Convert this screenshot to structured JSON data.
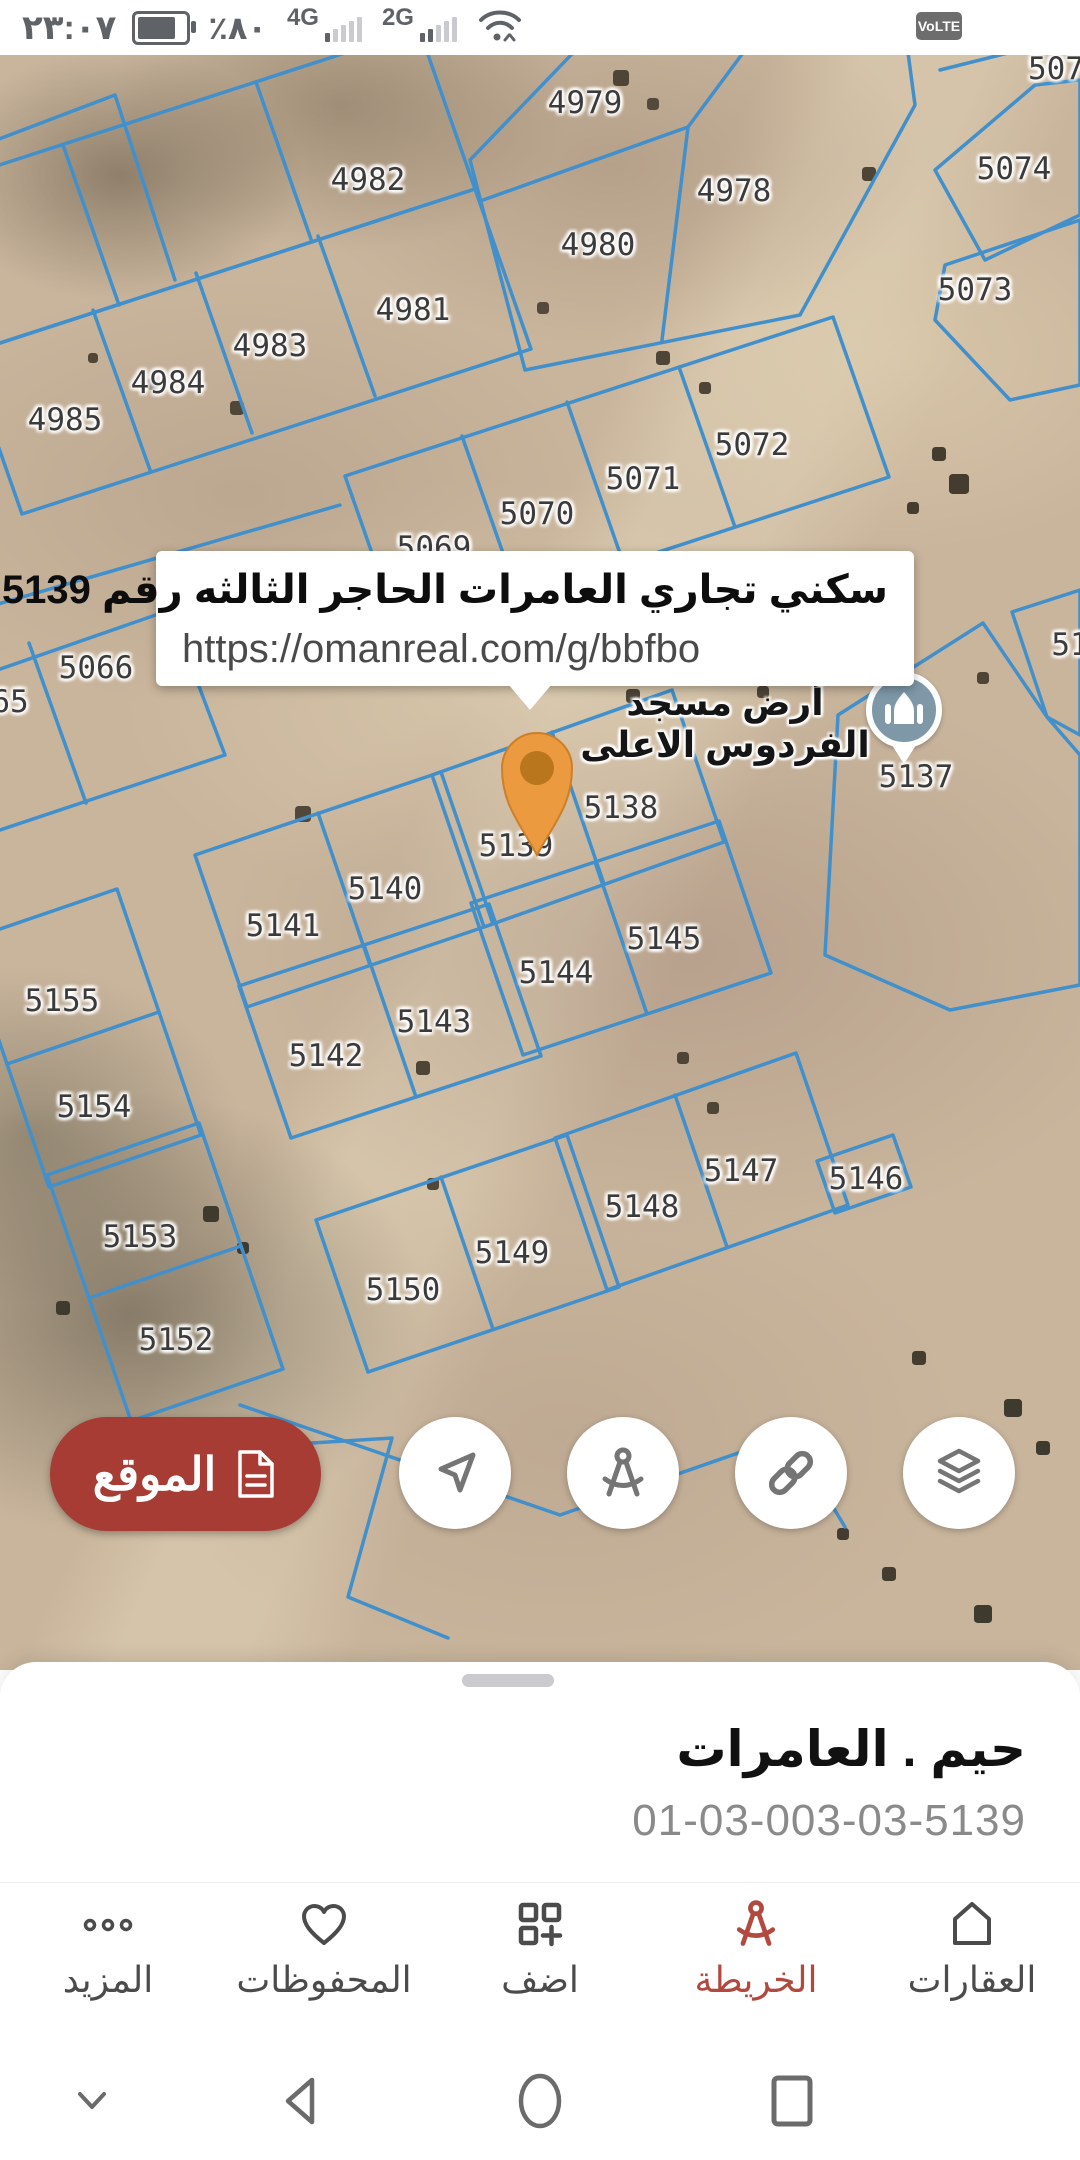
{
  "status_bar": {
    "time": "٢٣:٠٧",
    "battery_percent": "٪٨٠",
    "network_a": "4G",
    "network_b": "2G",
    "volte_badge": "VoLTE"
  },
  "map": {
    "popup": {
      "title": "سكني تجاري العامرات الحاجر الثالثه رقم 5139",
      "url": "https://omanreal.com/g/bbfbo"
    },
    "mosque_label": {
      "line1": "أرض مسجد",
      "line2": "الفردوس الاعلى"
    },
    "location_button": {
      "label": "الموقع"
    },
    "marker_parcel": "5139",
    "parcels": [
      {
        "n": "4979",
        "x": 585,
        "y": 48
      },
      {
        "n": "507",
        "x": 1056,
        "y": 14
      },
      {
        "n": "4982",
        "x": 368,
        "y": 125
      },
      {
        "n": "4978",
        "x": 734,
        "y": 136
      },
      {
        "n": "5074",
        "x": 1014,
        "y": 114
      },
      {
        "n": "4980",
        "x": 598,
        "y": 190
      },
      {
        "n": "5073",
        "x": 975,
        "y": 235
      },
      {
        "n": "4981",
        "x": 413,
        "y": 255
      },
      {
        "n": "4983",
        "x": 270,
        "y": 291
      },
      {
        "n": "4984",
        "x": 168,
        "y": 328
      },
      {
        "n": "4985",
        "x": 65,
        "y": 365
      },
      {
        "n": "5072",
        "x": 752,
        "y": 390
      },
      {
        "n": "5071",
        "x": 643,
        "y": 424
      },
      {
        "n": "5070",
        "x": 537,
        "y": 459
      },
      {
        "n": "5069",
        "x": 434,
        "y": 493
      },
      {
        "n": "5066",
        "x": 96,
        "y": 613
      },
      {
        "n": "65",
        "x": 10,
        "y": 647
      },
      {
        "n": "51",
        "x": 1070,
        "y": 590
      },
      {
        "n": "5137",
        "x": 916,
        "y": 722
      },
      {
        "n": "5138",
        "x": 621,
        "y": 753
      },
      {
        "n": "5139",
        "x": 516,
        "y": 791
      },
      {
        "n": "5140",
        "x": 385,
        "y": 834
      },
      {
        "n": "5141",
        "x": 283,
        "y": 871
      },
      {
        "n": "5145",
        "x": 664,
        "y": 884
      },
      {
        "n": "5144",
        "x": 556,
        "y": 918
      },
      {
        "n": "5143",
        "x": 434,
        "y": 967
      },
      {
        "n": "5155",
        "x": 62,
        "y": 946
      },
      {
        "n": "5142",
        "x": 326,
        "y": 1001
      },
      {
        "n": "5154",
        "x": 94,
        "y": 1052
      },
      {
        "n": "5153",
        "x": 140,
        "y": 1182
      },
      {
        "n": "5147",
        "x": 741,
        "y": 1116
      },
      {
        "n": "5146",
        "x": 866,
        "y": 1124
      },
      {
        "n": "5148",
        "x": 642,
        "y": 1152
      },
      {
        "n": "5149",
        "x": 512,
        "y": 1198
      },
      {
        "n": "5150",
        "x": 403,
        "y": 1235
      },
      {
        "n": "5152",
        "x": 176,
        "y": 1285
      }
    ]
  },
  "bottom_sheet": {
    "title": "حيم . العامرات",
    "parcel_code": "01-03-003-03-5139"
  },
  "bottom_nav": {
    "items": [
      {
        "label": "العقارات",
        "icon": "home-icon",
        "active": false
      },
      {
        "label": "الخريطة",
        "icon": "compass-icon",
        "active": true
      },
      {
        "label": "اضف",
        "icon": "add-grid-icon",
        "active": false
      },
      {
        "label": "المحفوظات",
        "icon": "heart-icon",
        "active": false
      },
      {
        "label": "المزيد",
        "icon": "more-dots-icon",
        "active": false
      }
    ]
  },
  "android_nav": {
    "buttons": [
      "collapse-chevron",
      "back",
      "home",
      "recents"
    ]
  },
  "colors": {
    "accent_red": "#a63c33",
    "active_nav_red": "#b2493f",
    "parcel_blue": "#4190cc",
    "pin_orange": "#ec9a3f",
    "mosque_pin_blue": "#7e98a8"
  }
}
